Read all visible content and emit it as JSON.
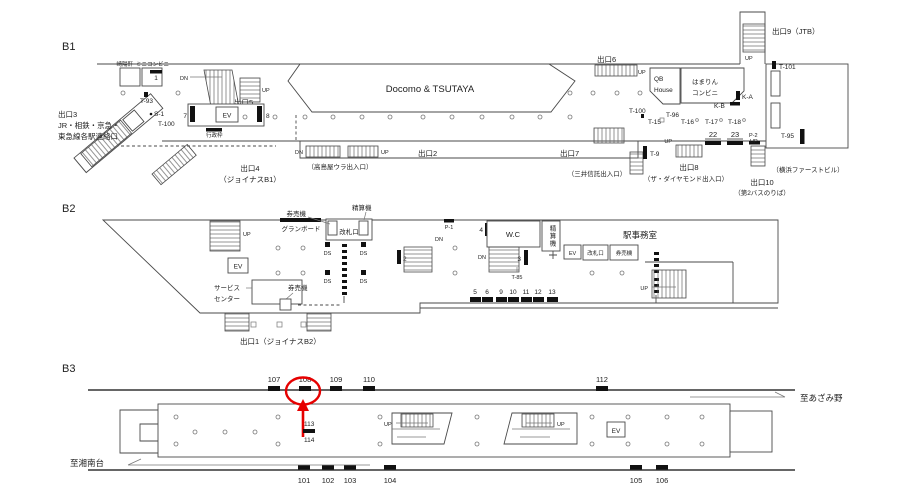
{
  "colors": {
    "line": "#4a4a4a",
    "bar": "#111111",
    "text": "#222222",
    "annotation": "#e60000"
  },
  "common": {
    "ev": "EV",
    "up": "UP",
    "dn": "DN"
  },
  "b1": {
    "level": "B1",
    "shop_kiyoken": "崎陽軒",
    "shop_mini_convenience": "ミニコンビニ",
    "shop_docomo": "Docomo & TSUTAYA",
    "shop_qb_1": "QB",
    "shop_qb_2": "House",
    "shop_hamarin_1": "はまりん",
    "shop_hamarin_2": "コンビニ",
    "exit2": "出口2",
    "exit3_1": "出口3",
    "exit3_2": "JR・相鉄・京急・",
    "exit3_3": "東急線各駅連絡口",
    "exit4_1": "出口4",
    "exit4_2": "（ジョイナスB1）",
    "exit5": "出口5",
    "exit6": "出口6",
    "exit7": "出口7",
    "exit8": "出口8",
    "exit9": "出口9（JTB）",
    "exit10_1": "出口10",
    "exit10_2": "（第2バスのりば）",
    "note_takashimaya": "（高島屋ウラ出入口）",
    "note_mitsui": "（三井信託出入口）",
    "note_diamond": "（ザ・ダイヤモンド出入口）",
    "note_first_bldg": "（横浜ファーストビル）",
    "gyosei": "行政枠",
    "slot1": "1",
    "slot7": "7",
    "slot8": "8",
    "slot22": "22",
    "slot23": "23",
    "t93": "T-93",
    "s1": "S-1",
    "t100_west": "T-100",
    "t100_east": "T-100",
    "t101": "T-101",
    "t15": "T-15",
    "t16": "T-16",
    "t17": "T-17",
    "t18": "T-18",
    "t96": "T-96",
    "t95": "T-95",
    "t9": "T-9",
    "p2": "P-2",
    "ka": "K-A",
    "kb": "K-B"
  },
  "b2": {
    "level": "B2",
    "ticket_machines_north": "券売機",
    "fare_adjust_north": "精算機",
    "grand_board": "グランボード",
    "gate_north": "改札口",
    "gate_east": "改札口",
    "ticket_machines_center": "券売機",
    "ticket_machines_east": "券売機",
    "fare_adjust_vertical": "精算機",
    "ds": "DS",
    "service_center_1": "サービス",
    "service_center_2": "センター",
    "exit1": "出口1（ジョイナスB2）",
    "office": "駅事務室",
    "wc": "W.C",
    "p1": "P-1",
    "t85": "T-85",
    "slot2": "2",
    "slot3": "3",
    "slot4": "4",
    "slot5": "5",
    "slot6": "6",
    "slot9": "9",
    "slot10": "10",
    "slot11": "11",
    "slot12": "12",
    "slot13": "13"
  },
  "b3": {
    "level": "B3",
    "to_shonandai": "至湘南台",
    "to_azamino": "至あざみ野",
    "slot101": "101",
    "slot102": "102",
    "slot103": "103",
    "slot104": "104",
    "slot105": "105",
    "slot106": "106",
    "slot107": "107",
    "slot108": "108",
    "slot109": "109",
    "slot110": "110",
    "slot112": "112",
    "slot113": "113",
    "slot114": "114"
  }
}
